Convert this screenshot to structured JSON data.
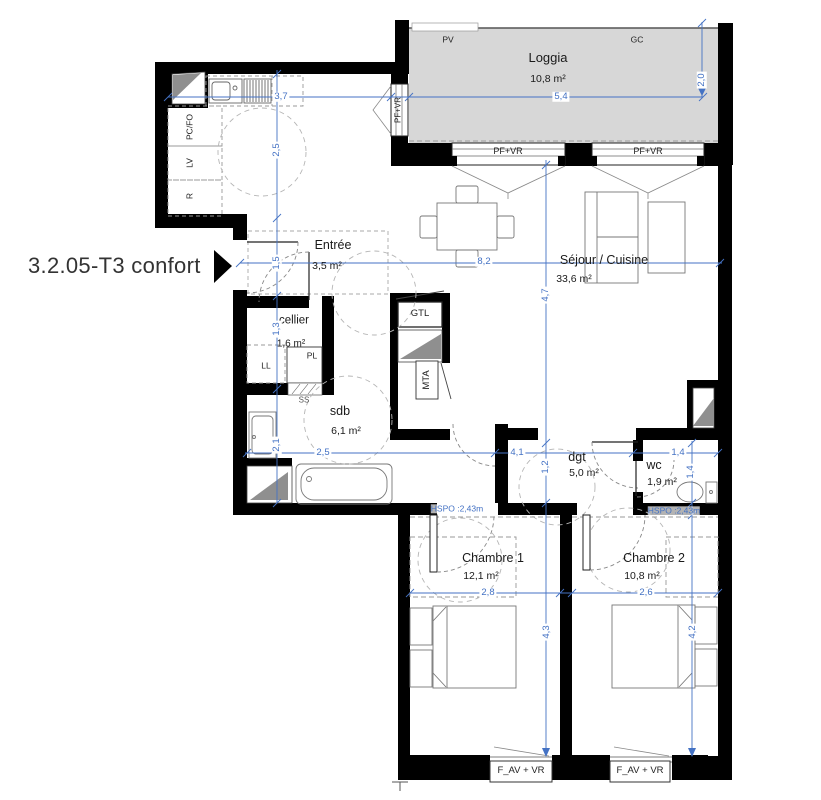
{
  "title": "3.2.05-T3 confort",
  "rooms": {
    "loggia": {
      "name": "Loggia",
      "area": "10,8 m²"
    },
    "entree": {
      "name": "Entrée",
      "area": "3,5 m²"
    },
    "sejour": {
      "name": "Séjour / Cuisine",
      "area": "33,6 m²"
    },
    "cellier": {
      "name": "cellier",
      "area": "1,6 m²"
    },
    "sdb": {
      "name": "sdb",
      "area": "6,1 m²"
    },
    "dgt": {
      "name": "dgt",
      "area": "5,0 m²"
    },
    "wc": {
      "name": "wc",
      "area": "1,9 m²"
    },
    "chambre1": {
      "name": "Chambre 1",
      "area": "12,1 m²"
    },
    "chambre2": {
      "name": "Chambre 2",
      "area": "10,8 m²"
    }
  },
  "labels": {
    "pv": "PV",
    "gc": "GC",
    "gtl": "GTL",
    "mta": "MTA",
    "pl": "PL",
    "ss": "SS",
    "ll": "LL",
    "pcfo": "PC/FO",
    "lv": "LV",
    "r": "R",
    "window_pfvr": "PF+VR",
    "window_favr": "F_AV + VR",
    "hspo": "HSPO :2,43m"
  },
  "dimensions": {
    "kitchen_width": "3,7",
    "kitchen_depth": "2,5",
    "entree_depth": "1,5",
    "cellier_depth": "1,3",
    "sdb_depth": "2,1",
    "total_width": "8,2",
    "loggia_width": "5,4",
    "loggia_depth": "2,0",
    "sejour_depth": "4,7",
    "dgt_depth": "1,2",
    "chambre1_depth": "4,3",
    "sdb_width": "2,5",
    "dgt_width": "4,1",
    "wc_width": "1,4",
    "wc_depth": "1,4",
    "chambre1_width": "2,8",
    "chambre2_width": "2,6",
    "chambre2_depth": "4,2"
  },
  "colors": {
    "dimension": "#4472c4",
    "wall": "#000000",
    "loggia_fill": "#d7d7d7",
    "shaft_fill": "#8f8f8f"
  }
}
